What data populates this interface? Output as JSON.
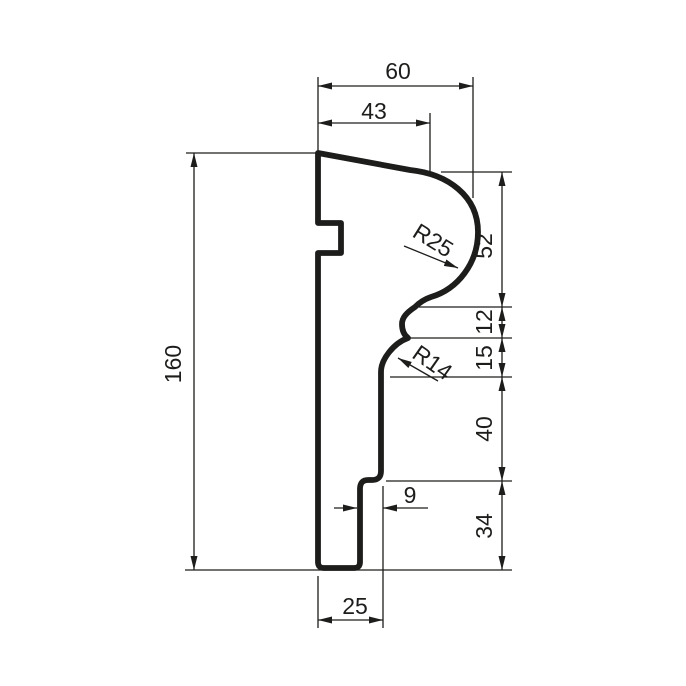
{
  "page": {
    "background_color": "#ffffff",
    "ink_color": "#1d1d1b"
  },
  "drawing": {
    "type": "profile-cross-section-technical-drawing",
    "labels": {
      "dim_width_top": "60",
      "dim_width_upper": "43",
      "dim_height_total": "160",
      "dim_seg_52": "52",
      "dim_seg_12": "12",
      "dim_seg_15": "15",
      "dim_seg_40": "40",
      "dim_seg_34": "34",
      "dim_step": "9",
      "dim_width_bottom": "25",
      "radius_large": "R25",
      "radius_small": "R14"
    }
  }
}
